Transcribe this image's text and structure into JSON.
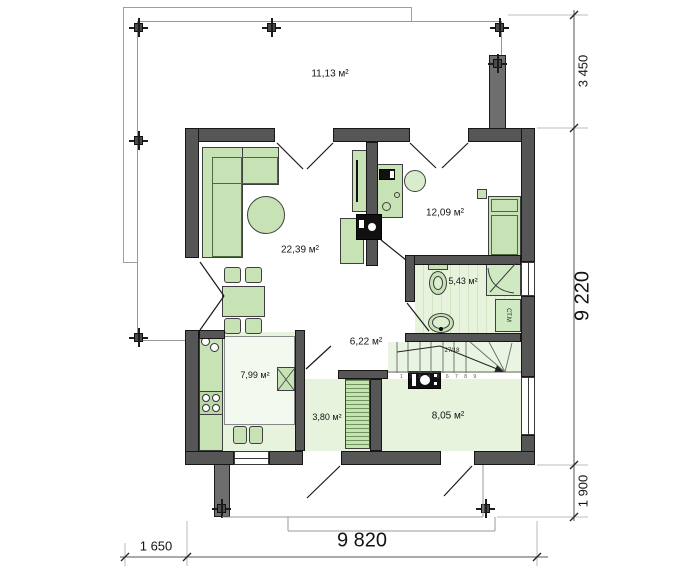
{
  "plan_type": "floor-plan",
  "terrace": {
    "area": "11,13 м²"
  },
  "rooms": {
    "living": "22,39 м²",
    "bedroom": "12,09 м²",
    "bathroom": "5,43 м²",
    "hall": "6,22 м²",
    "kitchen": "7,99 м²",
    "entry": "3,80 м²",
    "boiler": "8,05 м²"
  },
  "labels": {
    "washing_machine": "СТ.М",
    "stair_note": "27/18",
    "stair_steps": "1 2 3 4 5 6 7 8 9"
  },
  "dimensions": {
    "right_top": "3 450",
    "right_middle": "9 220",
    "right_bottom": "1 900",
    "bottom_left": "1 650",
    "bottom_width": "9 820"
  },
  "colors": {
    "wall": "#565656",
    "furniture": "#c7e3b6",
    "floor_tint": "#e8f3de",
    "line": "#1a1a1a"
  }
}
